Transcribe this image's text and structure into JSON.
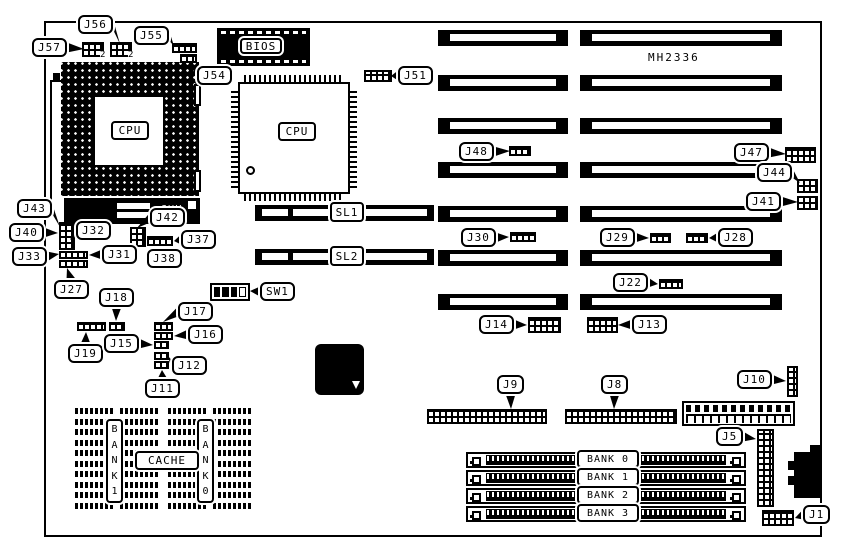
{
  "diagram": {
    "model": "MH2336",
    "pga_cpu": "CPU",
    "qfp_cpu": "CPU",
    "bios": "BIOS",
    "amd": "AMD",
    "sl1": "SL1",
    "sl2": "SL2",
    "cache": "CACHE",
    "cache_bank_left": "B\nA\nN\nK\n1",
    "cache_bank_right": "B\nA\nN\nK\n0",
    "pin2_markers": [
      "2",
      "2"
    ],
    "simm_banks": [
      "BANK 0",
      "BANK 1",
      "BANK 2",
      "BANK 3"
    ],
    "callouts": [
      {
        "label": "J56",
        "x": 78,
        "y": 15,
        "tx": 120,
        "ty": 44
      },
      {
        "label": "J55",
        "x": 134,
        "y": 26,
        "tx": 174,
        "ty": 46
      },
      {
        "label": "J57",
        "x": 32,
        "y": 38,
        "tx": 84,
        "ty": 49
      },
      {
        "label": "J54",
        "x": 197,
        "y": 66,
        "tx": 190,
        "ty": 61
      },
      {
        "label": "J51",
        "x": 398,
        "y": 66,
        "tx": 391,
        "ty": 76
      },
      {
        "label": "J48",
        "x": 459,
        "y": 142,
        "tx": 510,
        "ty": 151
      },
      {
        "label": "J47",
        "x": 734,
        "y": 143,
        "tx": 786,
        "ty": 154
      },
      {
        "label": "J44",
        "x": 757,
        "y": 163,
        "tx": 800,
        "ty": 183
      },
      {
        "label": "J41",
        "x": 746,
        "y": 192,
        "tx": 798,
        "ty": 202
      },
      {
        "label": "J43",
        "x": 17,
        "y": 199,
        "tx": 60,
        "ty": 227
      },
      {
        "label": "J40",
        "x": 9,
        "y": 223,
        "tx": 58,
        "ty": 233
      },
      {
        "label": "J33",
        "x": 12,
        "y": 247,
        "tx": 59,
        "ty": 254
      },
      {
        "label": "J32",
        "x": 76,
        "y": 221,
        "tx": 70,
        "ty": 240
      },
      {
        "label": "J31",
        "x": 102,
        "y": 245,
        "tx": 89,
        "ty": 255
      },
      {
        "label": "J27",
        "x": 54,
        "y": 280,
        "tx": 67,
        "ty": 268
      },
      {
        "label": "J42",
        "x": 150,
        "y": 208,
        "tx": 137,
        "ty": 228
      },
      {
        "label": "J37",
        "x": 181,
        "y": 230,
        "tx": 174,
        "ty": 241
      },
      {
        "label": "J38",
        "x": 147,
        "y": 249,
        "tx": 160,
        "ty": 247
      },
      {
        "label": "J18",
        "x": 99,
        "y": 288,
        "tx": 116,
        "ty": 321
      },
      {
        "label": "J19",
        "x": 68,
        "y": 344,
        "tx": 86,
        "ty": 332
      },
      {
        "label": "J17",
        "x": 178,
        "y": 302,
        "tx": 163,
        "ty": 322
      },
      {
        "label": "J16",
        "x": 188,
        "y": 325,
        "tx": 174,
        "ty": 336
      },
      {
        "label": "J15",
        "x": 104,
        "y": 334,
        "tx": 153,
        "ty": 345
      },
      {
        "label": "J12",
        "x": 172,
        "y": 356,
        "tx": 168,
        "ty": 356
      },
      {
        "label": "J11",
        "x": 145,
        "y": 379,
        "tx": 162,
        "ty": 370
      },
      {
        "label": "SW1",
        "x": 260,
        "y": 282,
        "tx": 250,
        "ty": 291
      },
      {
        "label": "J30",
        "x": 461,
        "y": 228,
        "tx": 509,
        "ty": 237
      },
      {
        "label": "J29",
        "x": 600,
        "y": 228,
        "tx": 649,
        "ty": 238
      },
      {
        "label": "J28",
        "x": 718,
        "y": 228,
        "tx": 709,
        "ty": 238
      },
      {
        "label": "J22",
        "x": 613,
        "y": 273,
        "tx": 658,
        "ty": 284
      },
      {
        "label": "J14",
        "x": 479,
        "y": 315,
        "tx": 527,
        "ty": 325
      },
      {
        "label": "J13",
        "x": 632,
        "y": 315,
        "tx": 618,
        "ty": 325
      },
      {
        "label": "J9",
        "x": 497,
        "y": 375,
        "tx": 511,
        "ty": 409
      },
      {
        "label": "J8",
        "x": 601,
        "y": 375,
        "tx": 614,
        "ty": 409
      },
      {
        "label": "J10",
        "x": 737,
        "y": 370,
        "tx": 786,
        "ty": 381
      },
      {
        "label": "J5",
        "x": 716,
        "y": 427,
        "tx": 756,
        "ty": 439
      },
      {
        "label": "J1",
        "x": 803,
        "y": 505,
        "tx": 795,
        "ty": 518
      }
    ]
  }
}
